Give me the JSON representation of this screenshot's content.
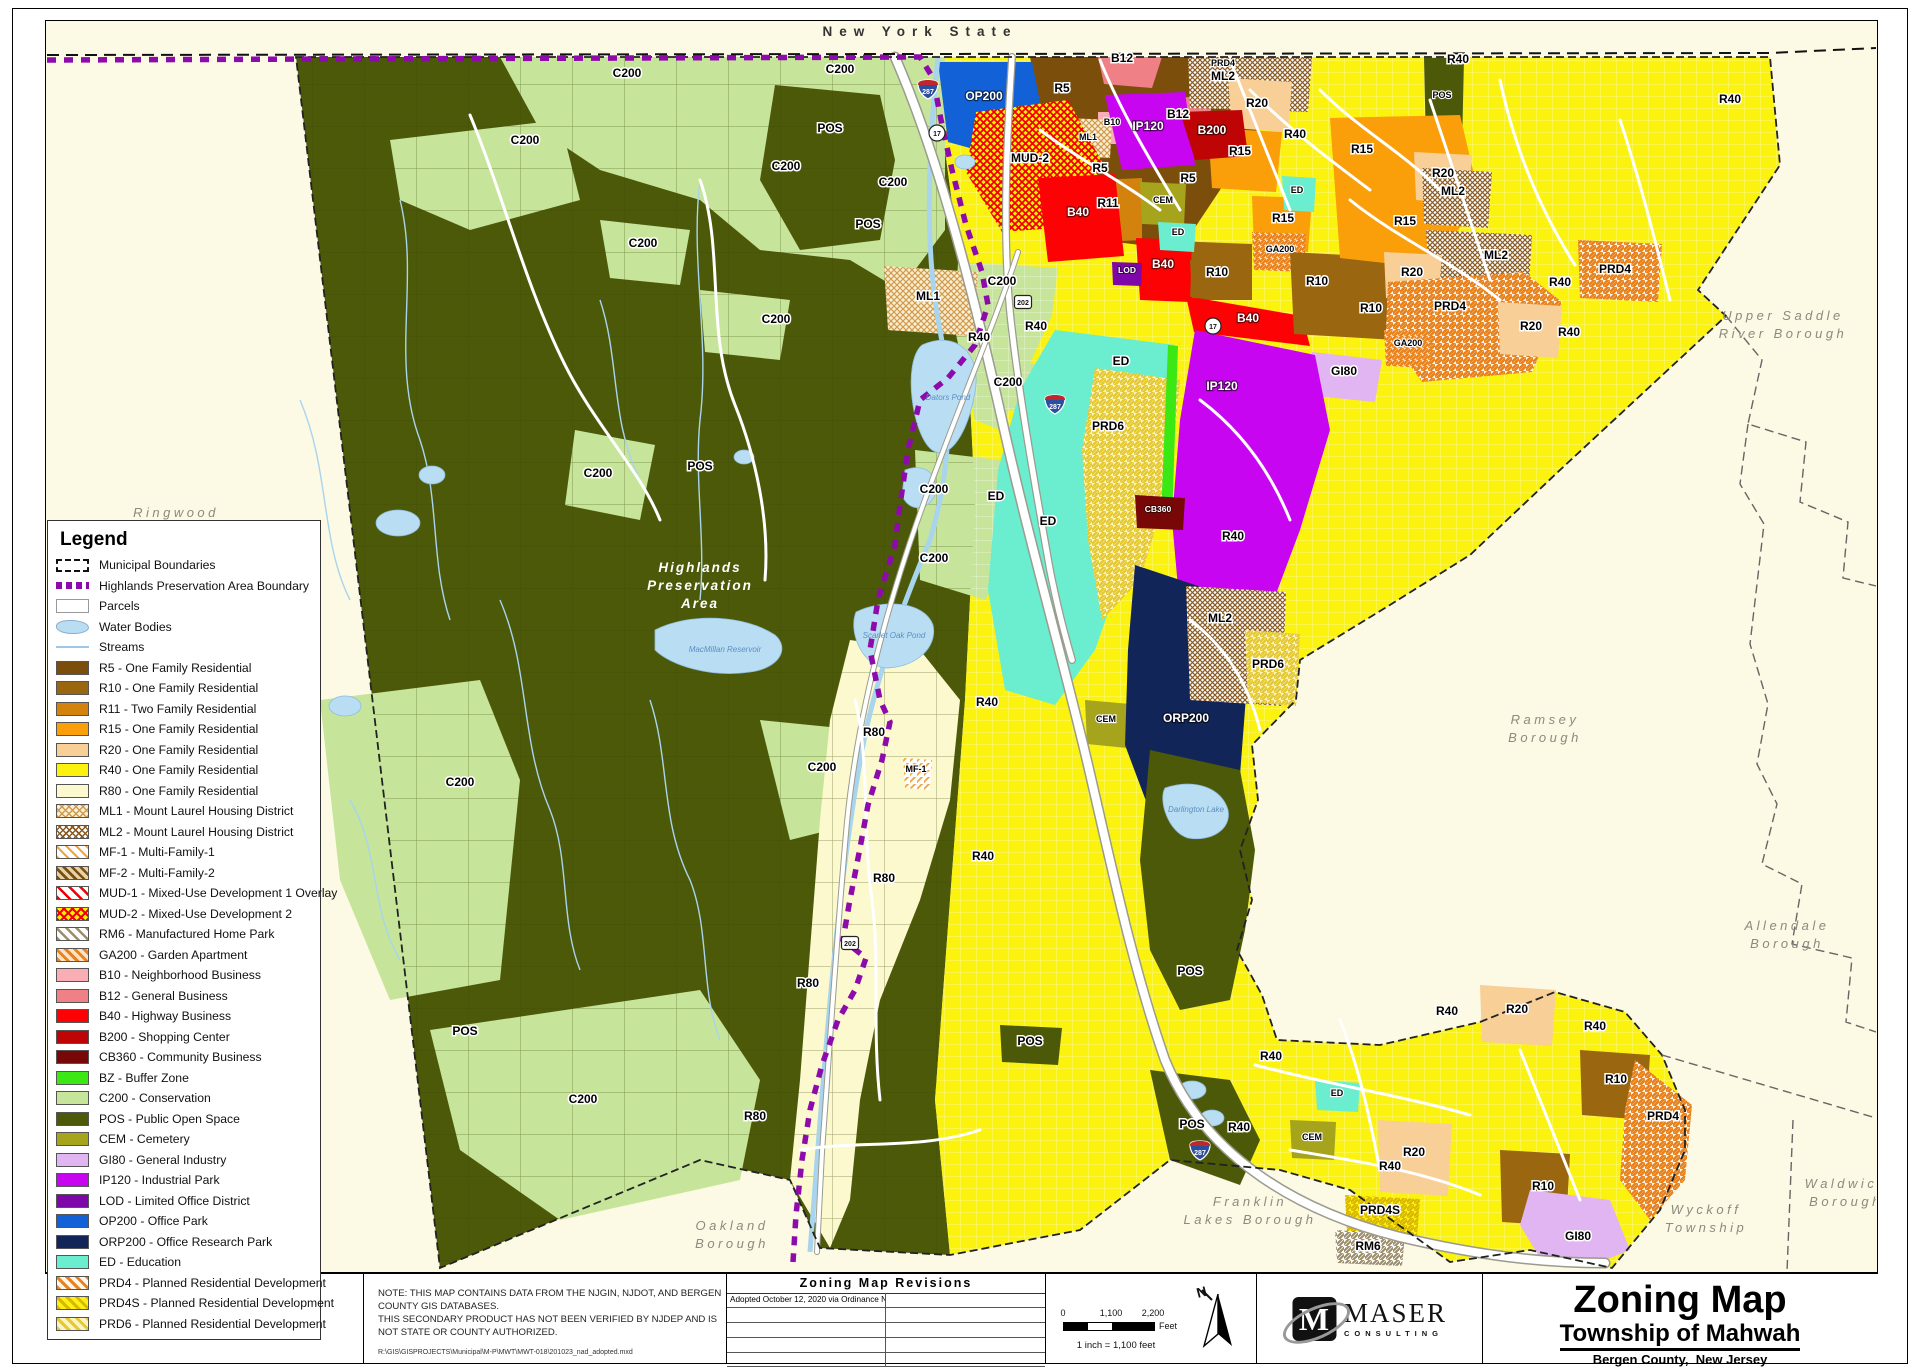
{
  "legend": {
    "title": "Legend",
    "items": [
      {
        "label": "Municipal Boundaries",
        "s": "municipal"
      },
      {
        "label": "Highlands Preservation Area Boundary",
        "s": "highlands"
      },
      {
        "label": "Parcels",
        "s": "parcels"
      },
      {
        "label": "Water Bodies",
        "s": "water"
      },
      {
        "label": "Streams",
        "s": "streams"
      },
      {
        "label": "R5 - One Family Residential",
        "s": "solid",
        "c": "#7B4E0B"
      },
      {
        "label": "R10 - One Family Residential",
        "s": "solid",
        "c": "#9A660F"
      },
      {
        "label": "R11 - Two Family Residential",
        "s": "solid",
        "c": "#D3820E"
      },
      {
        "label": "R15 - One Family Residential",
        "s": "solid",
        "c": "#FA9E0A"
      },
      {
        "label": "R20 - One Family Residential",
        "s": "solid",
        "c": "#F7CF97"
      },
      {
        "label": "R40 - One Family Residential",
        "s": "solid",
        "c": "#FBF30D"
      },
      {
        "label": "R80 - One Family Residential",
        "s": "solid",
        "c": "#FCF9CF"
      },
      {
        "label": "ML1 - Mount Laurel Housing District",
        "s": "ml1"
      },
      {
        "label": "ML2 - Mount Laurel Housing District",
        "s": "ml2"
      },
      {
        "label": "MF-1 - Multi-Family-1",
        "s": "mf1"
      },
      {
        "label": "MF-2 - Multi-Family-2",
        "s": "mf2"
      },
      {
        "label": "MUD-1 - Mixed-Use Development 1 Overlay",
        "s": "mud1"
      },
      {
        "label": "MUD-2 - Mixed-Use Development 2",
        "s": "mud2"
      },
      {
        "label": "RM6 - Manufactured Home Park",
        "s": "rm6"
      },
      {
        "label": "GA200 - Garden Apartment",
        "s": "ga200"
      },
      {
        "label": "B10 - Neighborhood Business",
        "s": "solid",
        "c": "#F8AEB4"
      },
      {
        "label": "B12 - General Business",
        "s": "solid",
        "c": "#EF8086"
      },
      {
        "label": "B40 - Highway Business",
        "s": "solid",
        "c": "#FC0204"
      },
      {
        "label": "B200 - Shopping Center",
        "s": "solid",
        "c": "#BE0404"
      },
      {
        "label": "CB360 - Community Business",
        "s": "solid",
        "c": "#780808"
      },
      {
        "label": "BZ - Buffer Zone",
        "s": "solid",
        "c": "#3BE814"
      },
      {
        "label": "C200 - Conservation",
        "s": "solid",
        "c": "#C7E59A"
      },
      {
        "label": "POS - Public Open Space",
        "s": "solid",
        "c": "#4C5909"
      },
      {
        "label": "CEM - Cemetery",
        "s": "solid",
        "c": "#A6A41C"
      },
      {
        "label": "GI80 - General Industry",
        "s": "solid",
        "c": "#E1B5F2"
      },
      {
        "label": "IP120 - Industrial Park",
        "s": "solid",
        "c": "#C705F0"
      },
      {
        "label": "LOD - Limited Office  District",
        "s": "solid",
        "c": "#7D07A8"
      },
      {
        "label": "OP200 - Office Park",
        "s": "solid",
        "c": "#1261D6"
      },
      {
        "label": "ORP200 - Office Research Park",
        "s": "solid",
        "c": "#122559"
      },
      {
        "label": "ED - Education",
        "s": "solid",
        "c": "#6AEECF"
      },
      {
        "label": "PRD4 - Planned Residential Development",
        "s": "prd4"
      },
      {
        "label": "PRD4S - Planned Residential Development",
        "s": "prd4s"
      },
      {
        "label": "PRD6 - Planned Residential Development",
        "s": "prd6"
      }
    ]
  },
  "map": {
    "labels": [
      [
        "New York State",
        920,
        36,
        "s"
      ],
      [
        "Ringwood",
        176,
        517,
        "b"
      ],
      [
        "Upper Saddle",
        1783,
        320,
        "b"
      ],
      [
        "River Borough",
        1783,
        338,
        "b"
      ],
      [
        "Ramsey",
        1545,
        724,
        "b"
      ],
      [
        "Borough",
        1545,
        742,
        "b"
      ],
      [
        "Allendale",
        1787,
        930,
        "b"
      ],
      [
        "Borough",
        1787,
        948,
        "b"
      ],
      [
        "Waldwick",
        1846,
        1188,
        "b"
      ],
      [
        "Borough",
        1846,
        1206,
        "b"
      ],
      [
        "Wyckoff",
        1706,
        1214,
        "b"
      ],
      [
        "Township",
        1706,
        1232,
        "b"
      ],
      [
        "Franklin",
        1250,
        1206,
        "b"
      ],
      [
        "Lakes Borough",
        1250,
        1224,
        "b"
      ],
      [
        "Oakland",
        732,
        1230,
        "b"
      ],
      [
        "Borough",
        732,
        1248,
        "b"
      ],
      [
        "Highlands",
        700,
        572,
        "hp"
      ],
      [
        "Preservation",
        700,
        590,
        "hp"
      ],
      [
        "Area",
        700,
        608,
        "hp"
      ],
      [
        "C200",
        525,
        144,
        "z"
      ],
      [
        "C200",
        627,
        77,
        "z"
      ],
      [
        "C200",
        840,
        73,
        "z"
      ],
      [
        "C200",
        786,
        170,
        "z"
      ],
      [
        "C200",
        893,
        186,
        "z"
      ],
      [
        "C200",
        643,
        247,
        "z"
      ],
      [
        "C200",
        776,
        323,
        "z"
      ],
      [
        "C200",
        1002,
        285,
        "z"
      ],
      [
        "C200",
        1008,
        386,
        "z"
      ],
      [
        "C200",
        598,
        477,
        "z"
      ],
      [
        "C200",
        934,
        493,
        "z"
      ],
      [
        "C200",
        934,
        562,
        "z"
      ],
      [
        "C200",
        822,
        771,
        "z"
      ],
      [
        "C200",
        460,
        786,
        "z"
      ],
      [
        "C200",
        583,
        1103,
        "z"
      ],
      [
        "POS",
        830,
        132,
        "z"
      ],
      [
        "POS",
        868,
        228,
        "z"
      ],
      [
        "POS",
        700,
        470,
        "z"
      ],
      [
        "POS",
        465,
        1035,
        "z"
      ],
      [
        "POS",
        1030,
        1045,
        "z"
      ],
      [
        "POS",
        1190,
        975,
        "z"
      ],
      [
        "POS",
        1192,
        1128,
        "z"
      ],
      [
        "POS",
        1442,
        98,
        "zs"
      ],
      [
        "R40",
        979,
        341,
        "z"
      ],
      [
        "R40",
        1036,
        330,
        "z"
      ],
      [
        "R40",
        987,
        706,
        "z"
      ],
      [
        "R40",
        983,
        860,
        "z"
      ],
      [
        "R40",
        1295,
        138,
        "z"
      ],
      [
        "R40",
        1458,
        63,
        "z"
      ],
      [
        "R40",
        1730,
        103,
        "z"
      ],
      [
        "R40",
        1560,
        286,
        "z"
      ],
      [
        "R40",
        1569,
        336,
        "z"
      ],
      [
        "R40",
        1233,
        540,
        "z"
      ],
      [
        "R40",
        1271,
        1060,
        "z"
      ],
      [
        "R40",
        1447,
        1015,
        "z"
      ],
      [
        "R40",
        1595,
        1030,
        "z"
      ],
      [
        "R40",
        1239,
        1131,
        "z"
      ],
      [
        "R40",
        1390,
        1170,
        "z"
      ],
      [
        "R80",
        874,
        736,
        "z"
      ],
      [
        "R80",
        884,
        882,
        "z"
      ],
      [
        "R80",
        808,
        987,
        "z"
      ],
      [
        "R80",
        755,
        1120,
        "z"
      ],
      [
        "ED",
        1121,
        365,
        "z"
      ],
      [
        "ED",
        996,
        500,
        "z"
      ],
      [
        "ED",
        1048,
        525,
        "z"
      ],
      [
        "ED",
        1297,
        193,
        "zs"
      ],
      [
        "ED",
        1178,
        235,
        "zs"
      ],
      [
        "ED",
        1337,
        1096,
        "zs"
      ],
      [
        "R5",
        1062,
        92,
        "z"
      ],
      [
        "R5",
        1100,
        172,
        "z"
      ],
      [
        "R5",
        1188,
        182,
        "z"
      ],
      [
        "R10",
        1217,
        276,
        "z"
      ],
      [
        "R10",
        1317,
        285,
        "z"
      ],
      [
        "R10",
        1371,
        312,
        "z"
      ],
      [
        "R10",
        1616,
        1083,
        "z"
      ],
      [
        "R10",
        1543,
        1190,
        "z"
      ],
      [
        "R11",
        1108,
        207,
        "z"
      ],
      [
        "R15",
        1240,
        155,
        "z"
      ],
      [
        "R15",
        1362,
        153,
        "z"
      ],
      [
        "R15",
        1405,
        225,
        "z"
      ],
      [
        "R15",
        1283,
        222,
        "z"
      ],
      [
        "R20",
        1257,
        107,
        "z"
      ],
      [
        "R20",
        1443,
        177,
        "z"
      ],
      [
        "R20",
        1412,
        276,
        "z"
      ],
      [
        "R20",
        1531,
        330,
        "z"
      ],
      [
        "R20",
        1517,
        1013,
        "z"
      ],
      [
        "R20",
        1414,
        1156,
        "z"
      ],
      [
        "B10",
        1112,
        125,
        "zs"
      ],
      [
        "B12",
        1122,
        62,
        "z"
      ],
      [
        "B12",
        1178,
        118,
        "z"
      ],
      [
        "B40",
        1078,
        216,
        "w"
      ],
      [
        "B40",
        1163,
        268,
        "w"
      ],
      [
        "B40",
        1248,
        322,
        "w"
      ],
      [
        "B200",
        1212,
        134,
        "w"
      ],
      [
        "CB360",
        1158,
        512,
        "ws"
      ],
      [
        "LOD",
        1127,
        273,
        "ws"
      ],
      [
        "OP200",
        984,
        100,
        "w"
      ],
      [
        "ORP200",
        1186,
        722,
        "w"
      ],
      [
        "IP120",
        1148,
        130,
        "w"
      ],
      [
        "IP120",
        1222,
        390,
        "w"
      ],
      [
        "MUD-2",
        1030,
        162,
        "z"
      ],
      [
        "GA200",
        1280,
        252,
        "zs"
      ],
      [
        "GA200",
        1408,
        346,
        "zs"
      ],
      [
        "ML1",
        928,
        300,
        "z"
      ],
      [
        "ML1",
        1088,
        140,
        "zs"
      ],
      [
        "ML2",
        1223,
        80,
        "z"
      ],
      [
        "ML2",
        1453,
        195,
        "z"
      ],
      [
        "ML2",
        1496,
        259,
        "z"
      ],
      [
        "ML2",
        1220,
        622,
        "z"
      ],
      [
        "MF-1",
        916,
        772,
        "zs"
      ],
      [
        "CEM",
        1163,
        203,
        "zs"
      ],
      [
        "CEM",
        1312,
        1140,
        "zs"
      ],
      [
        "CEM",
        1106,
        722,
        "zs"
      ],
      [
        "PRD6",
        1108,
        430,
        "z"
      ],
      [
        "PRD6",
        1268,
        668,
        "z"
      ],
      [
        "PRD4",
        1223,
        66,
        "zs"
      ],
      [
        "PRD4",
        1450,
        310,
        "z"
      ],
      [
        "PRD4",
        1615,
        273,
        "z"
      ],
      [
        "PRD4",
        1663,
        1120,
        "z"
      ],
      [
        "PRD4S",
        1380,
        1214,
        "z"
      ],
      [
        "RM6",
        1368,
        1250,
        "z"
      ],
      [
        "GI80",
        1578,
        1240,
        "z"
      ],
      [
        "GI80",
        1344,
        375,
        "z"
      ],
      [
        "MacMillan Reservoir",
        725,
        652,
        "wa"
      ],
      [
        "Scarlet Oak Pond",
        894,
        638,
        "wa"
      ],
      [
        "Dators Pond",
        948,
        400,
        "wa"
      ],
      [
        "Darlington Lake",
        1196,
        812,
        "wa"
      ]
    ],
    "shields": [
      [
        "i287",
        928,
        90
      ],
      [
        "i287",
        1055,
        405
      ],
      [
        "i287",
        1200,
        1151
      ],
      [
        "c17",
        937,
        133
      ],
      [
        "c17",
        1213,
        326
      ],
      [
        "s202",
        1023,
        302
      ],
      [
        "s202",
        850,
        943
      ]
    ]
  },
  "bottom": {
    "note_line1": "NOTE:  THIS MAP CONTAINS DATA FROM THE NJGIN, NJDOT, AND BERGEN COUNTY GIS DATABASES.",
    "note_line2": "THIS SECONDARY PRODUCT HAS NOT BEEN VERIFIED BY NJDEP AND IS NOT STATE OR COUNTY AUTHORIZED.",
    "file_path": "R:\\GIS\\GISPROJECTS\\Municipal\\M-P\\MWT\\MWT-018\\201023_nad_adopted.mxd",
    "revisions": {
      "title": "Zoning Map Revisions",
      "rows": [
        [
          "Adopted October 12, 2020 via Ordinance No. 1916",
          ""
        ],
        [
          "",
          ""
        ],
        [
          "",
          ""
        ],
        [
          "",
          ""
        ],
        [
          "",
          ""
        ]
      ]
    },
    "scale": {
      "t0": "0",
      "t1": "1,100",
      "t2": "2,200",
      "unit": "Feet",
      "ratio": "1 inch = 1,100 feet"
    },
    "north_label": "N",
    "logo": {
      "glyph": "M",
      "name": "MASER",
      "sub": "CONSULTING"
    },
    "title_block": {
      "title": "Zoning Map",
      "municipality": "Township of Mahwah",
      "county": "Bergen County,",
      "state": "New Jersey",
      "date": "October 12, 2020"
    }
  }
}
